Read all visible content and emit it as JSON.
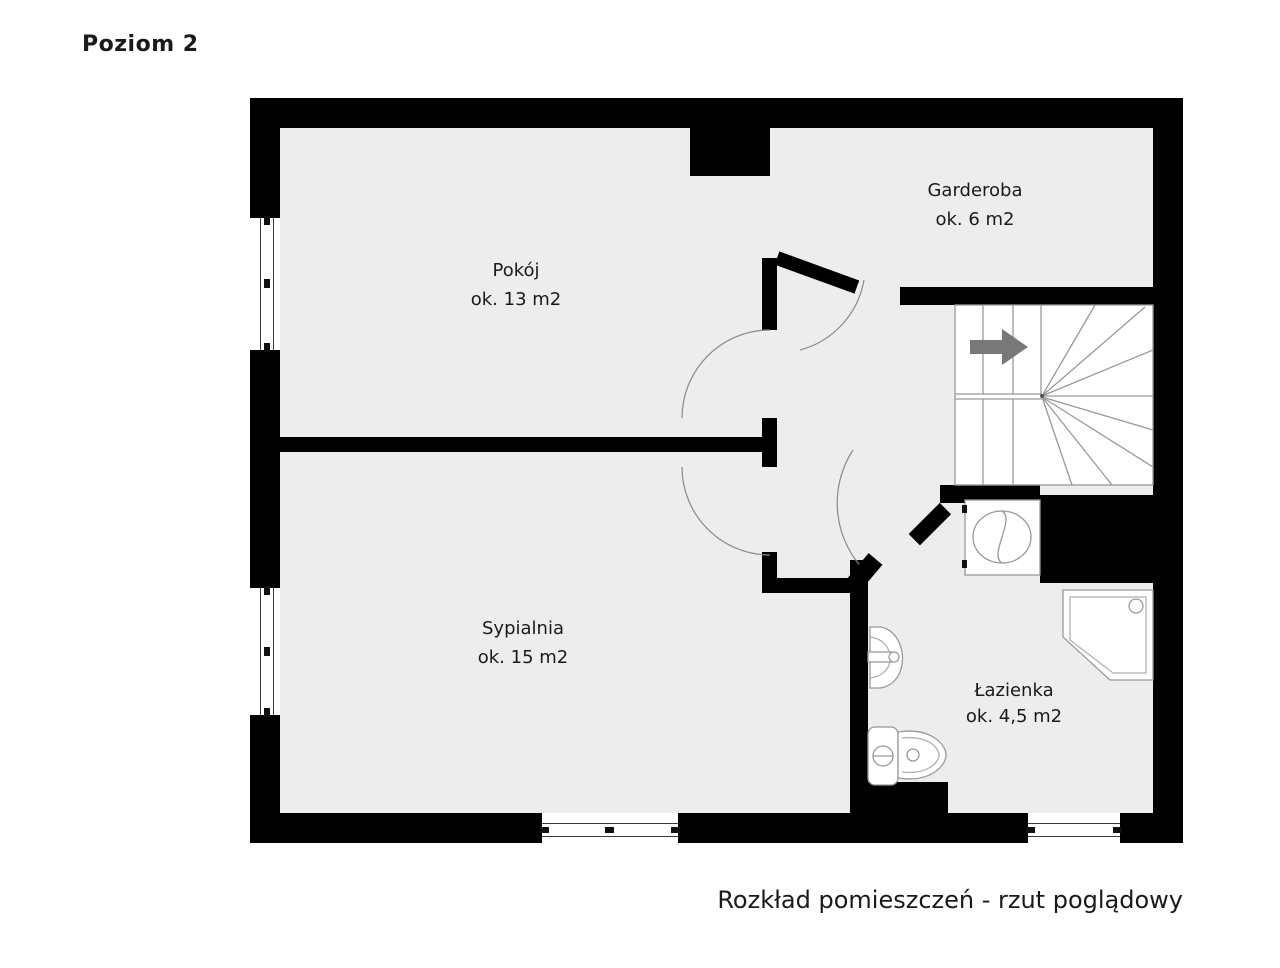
{
  "title": "Poziom 2",
  "caption": "Rozkład pomieszczeń - rzut poglądowy",
  "rooms": [
    {
      "id": "pokoj",
      "name": "Pokój",
      "area": "ok. 13 m2"
    },
    {
      "id": "garderoba",
      "name": "Garderoba",
      "area": "ok. 6 m2"
    },
    {
      "id": "sypialnia",
      "name": "Sypialnia",
      "area": "ok. 15 m2"
    },
    {
      "id": "lazienka",
      "name": "Łazienka",
      "area": "ok. 4,5 m2"
    }
  ],
  "stairs": {
    "icon": "stairs-up-arrow-icon",
    "arrow_direction": "right"
  },
  "fixtures": [
    "washing-machine-icon",
    "corner-shower-icon",
    "sink-icon",
    "toilet-icon"
  ],
  "doors": [
    "pokoj-door",
    "sypialnia-door",
    "garderoba-door",
    "lazienka-door"
  ],
  "windows_count": 4,
  "colors": {
    "wall": "#000000",
    "floor": "#ededed",
    "outline": "#999999",
    "stair_arrow": "#787878",
    "text": "#1a1a1a",
    "background": "#ffffff"
  }
}
